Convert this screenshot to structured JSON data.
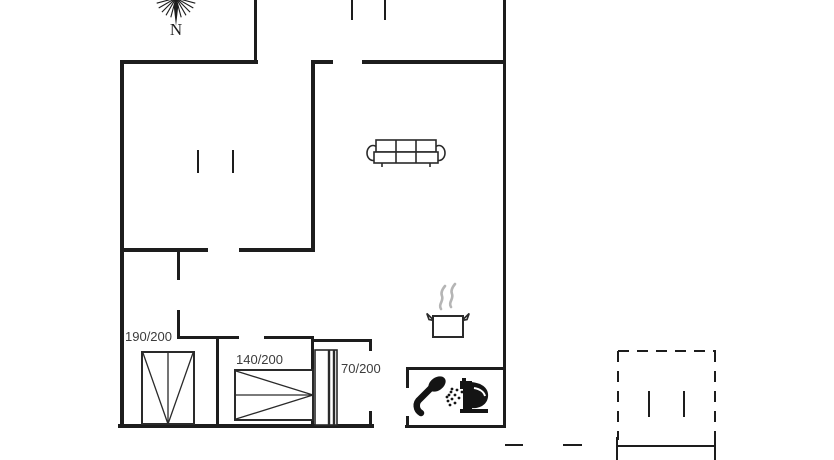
{
  "plan": {
    "compass_label": "N",
    "beds": [
      {
        "label": "190/200"
      },
      {
        "label": "140/200"
      },
      {
        "label": "70/200"
      }
    ],
    "icons": [
      "compass-rose-icon",
      "sofa-icon",
      "cooking-pot-icon",
      "shower-icon",
      "toilet-icon"
    ],
    "colors": {
      "wall": "#1d1d1d",
      "text": "#3c3c3c",
      "steam": "#b5b5b5",
      "background": "#ffffff"
    }
  }
}
